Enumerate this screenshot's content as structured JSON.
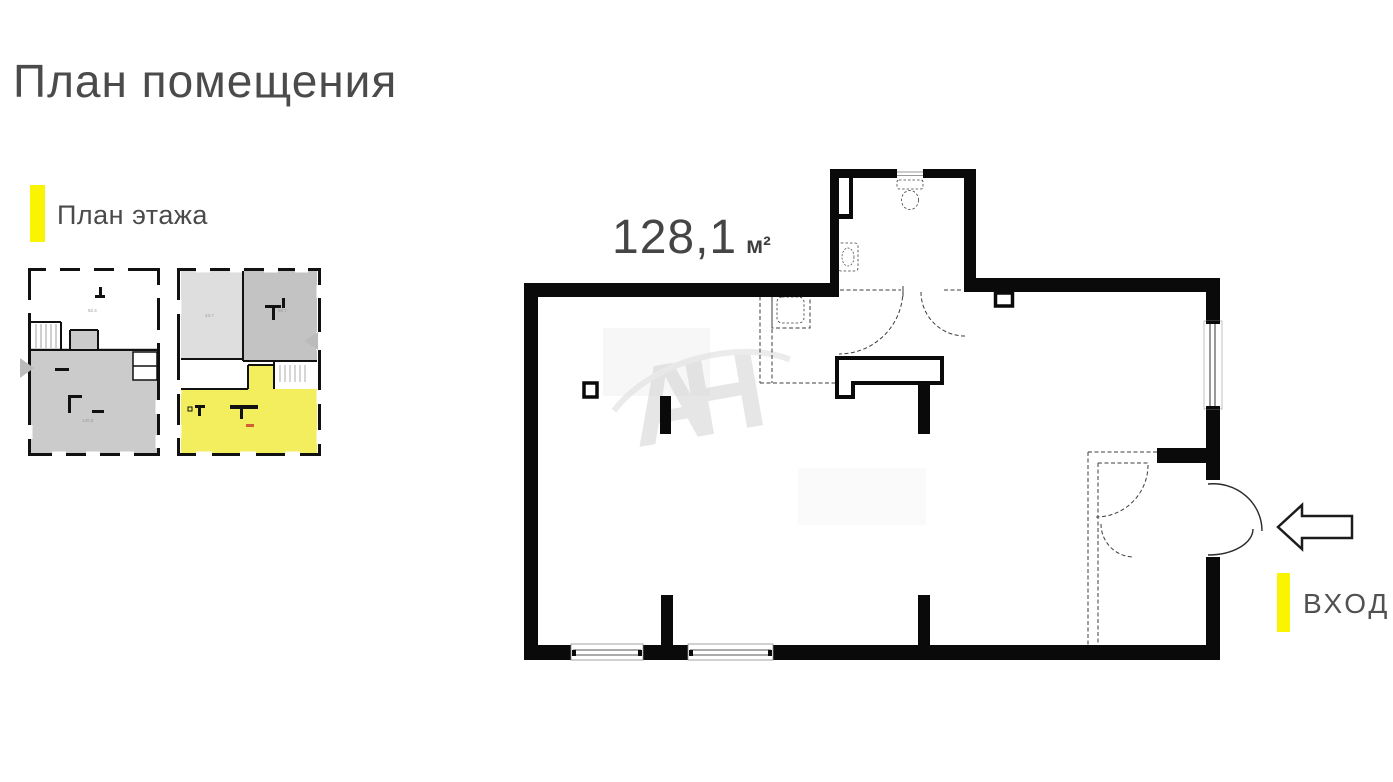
{
  "page": {
    "title": "План помещения"
  },
  "legend": {
    "label": "План этажа",
    "accent_color": "#FAF400"
  },
  "floor_thumbnails": {
    "first": {
      "rooms": [
        {
          "label": "92.4"
        },
        {
          "label": "140.8"
        }
      ]
    },
    "second": {
      "rooms": [
        {
          "label": "43.7"
        },
        {
          "label": "80.7"
        }
      ],
      "highlight_color": "#F2EE5E"
    }
  },
  "main_plan": {
    "area_value": "128,1",
    "area_unit": "м²",
    "watermark": "АН"
  },
  "entrance": {
    "label": "ВХОД"
  },
  "colors": {
    "accent_yellow": "#FAF400",
    "highlight_room_yellow": "#F2EE5E",
    "wall_black": "#0a0a0a",
    "text_gray": "#4a4a4a",
    "watermark_gray": "#d2d2d2",
    "thumb_gray_dark": "#c3c3c3",
    "thumb_gray_light": "#dedede"
  }
}
